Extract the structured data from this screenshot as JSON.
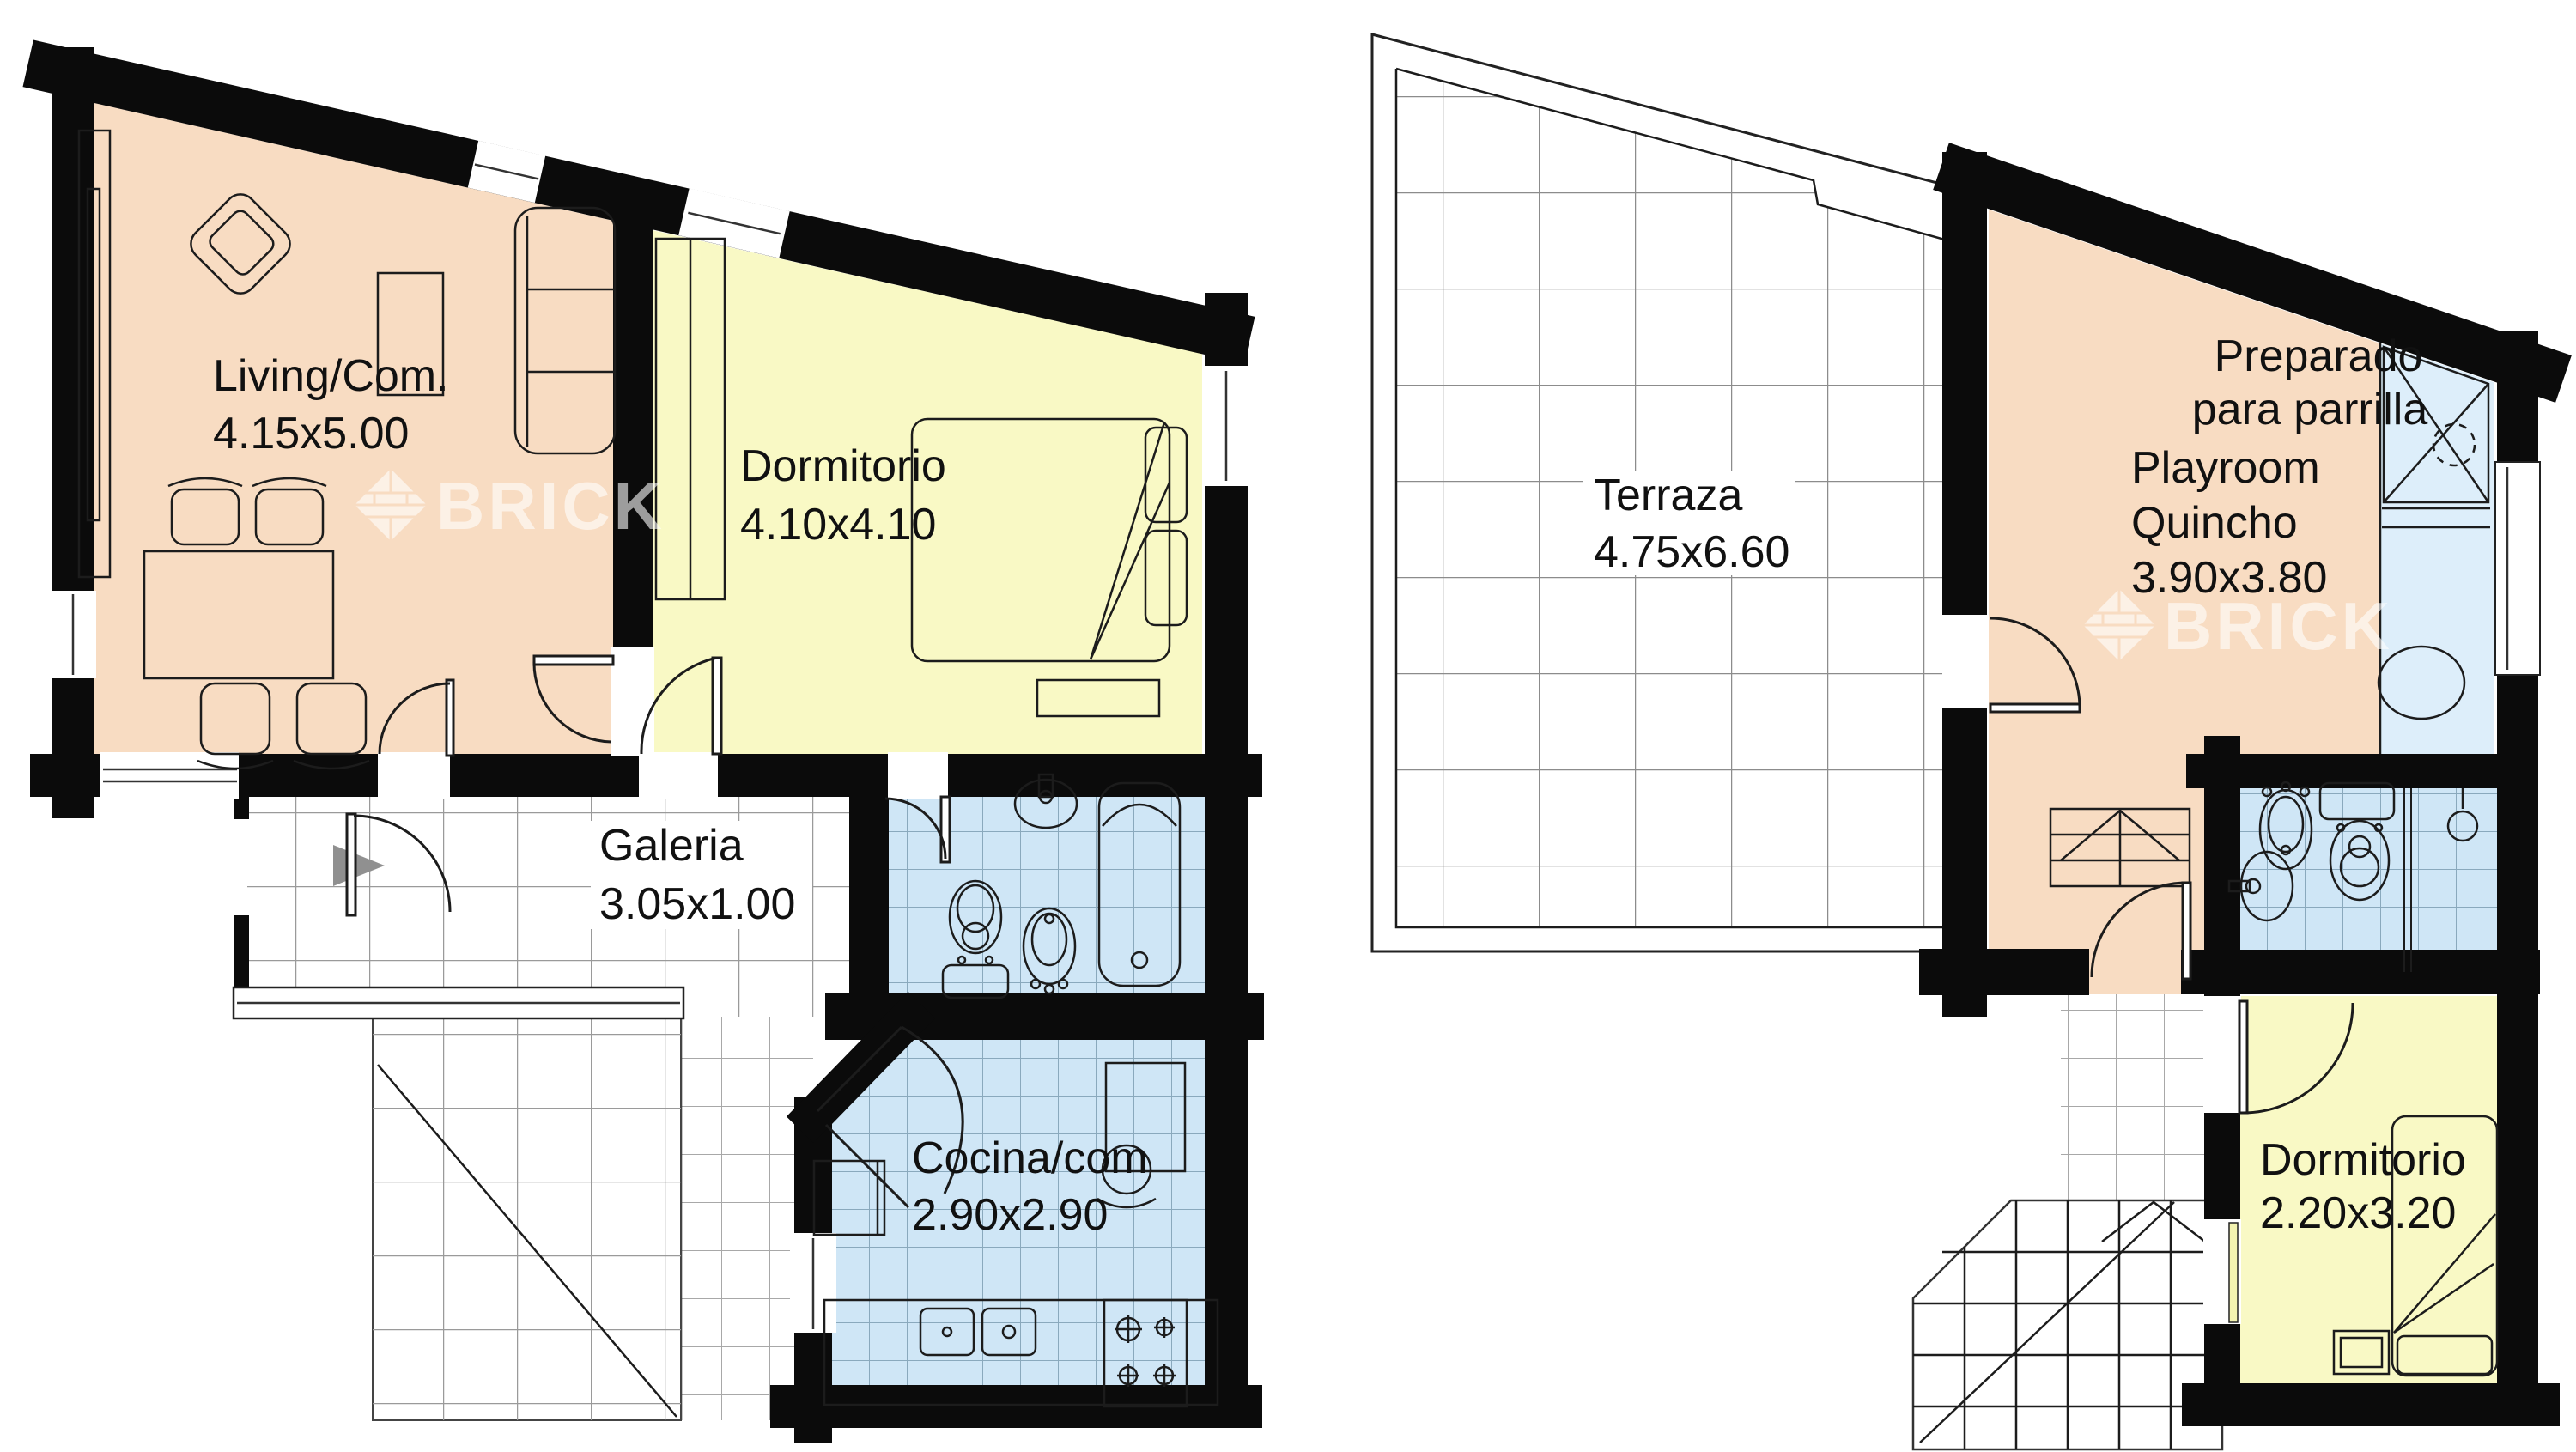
{
  "watermark": {
    "text": "BRICK"
  },
  "colors": {
    "wall": "#0b0b0b",
    "room_peach": "#f8dcc2",
    "room_yellow": "#f9f9c5",
    "room_blue": "#cfe6f6",
    "strip_blue": "#ddeefa",
    "grid_gray": "#9a9a9a",
    "entrance_arrow_gray": "#909090"
  },
  "left_plan": {
    "living": {
      "name": "Living/Com.",
      "dims": "4.15x5.00"
    },
    "dormitorio": {
      "name": "Dormitorio",
      "dims": "4.10x4.10"
    },
    "galeria": {
      "name": "Galeria",
      "dims": "3.05x1.00"
    },
    "cocina": {
      "name": "Cocina/com",
      "dims": "2.90x2.90"
    }
  },
  "right_plan": {
    "terraza": {
      "name": "Terraza",
      "dims": "4.75x6.60"
    },
    "parrilla_note": {
      "line1": "Preparado",
      "line2": "para parrilla"
    },
    "playroom": {
      "line1": "Playroom",
      "line2": "Quincho",
      "dims": "3.90x3.80"
    },
    "dormitorio": {
      "name": "Dormitorio",
      "dims": "2.20x3.20"
    }
  }
}
